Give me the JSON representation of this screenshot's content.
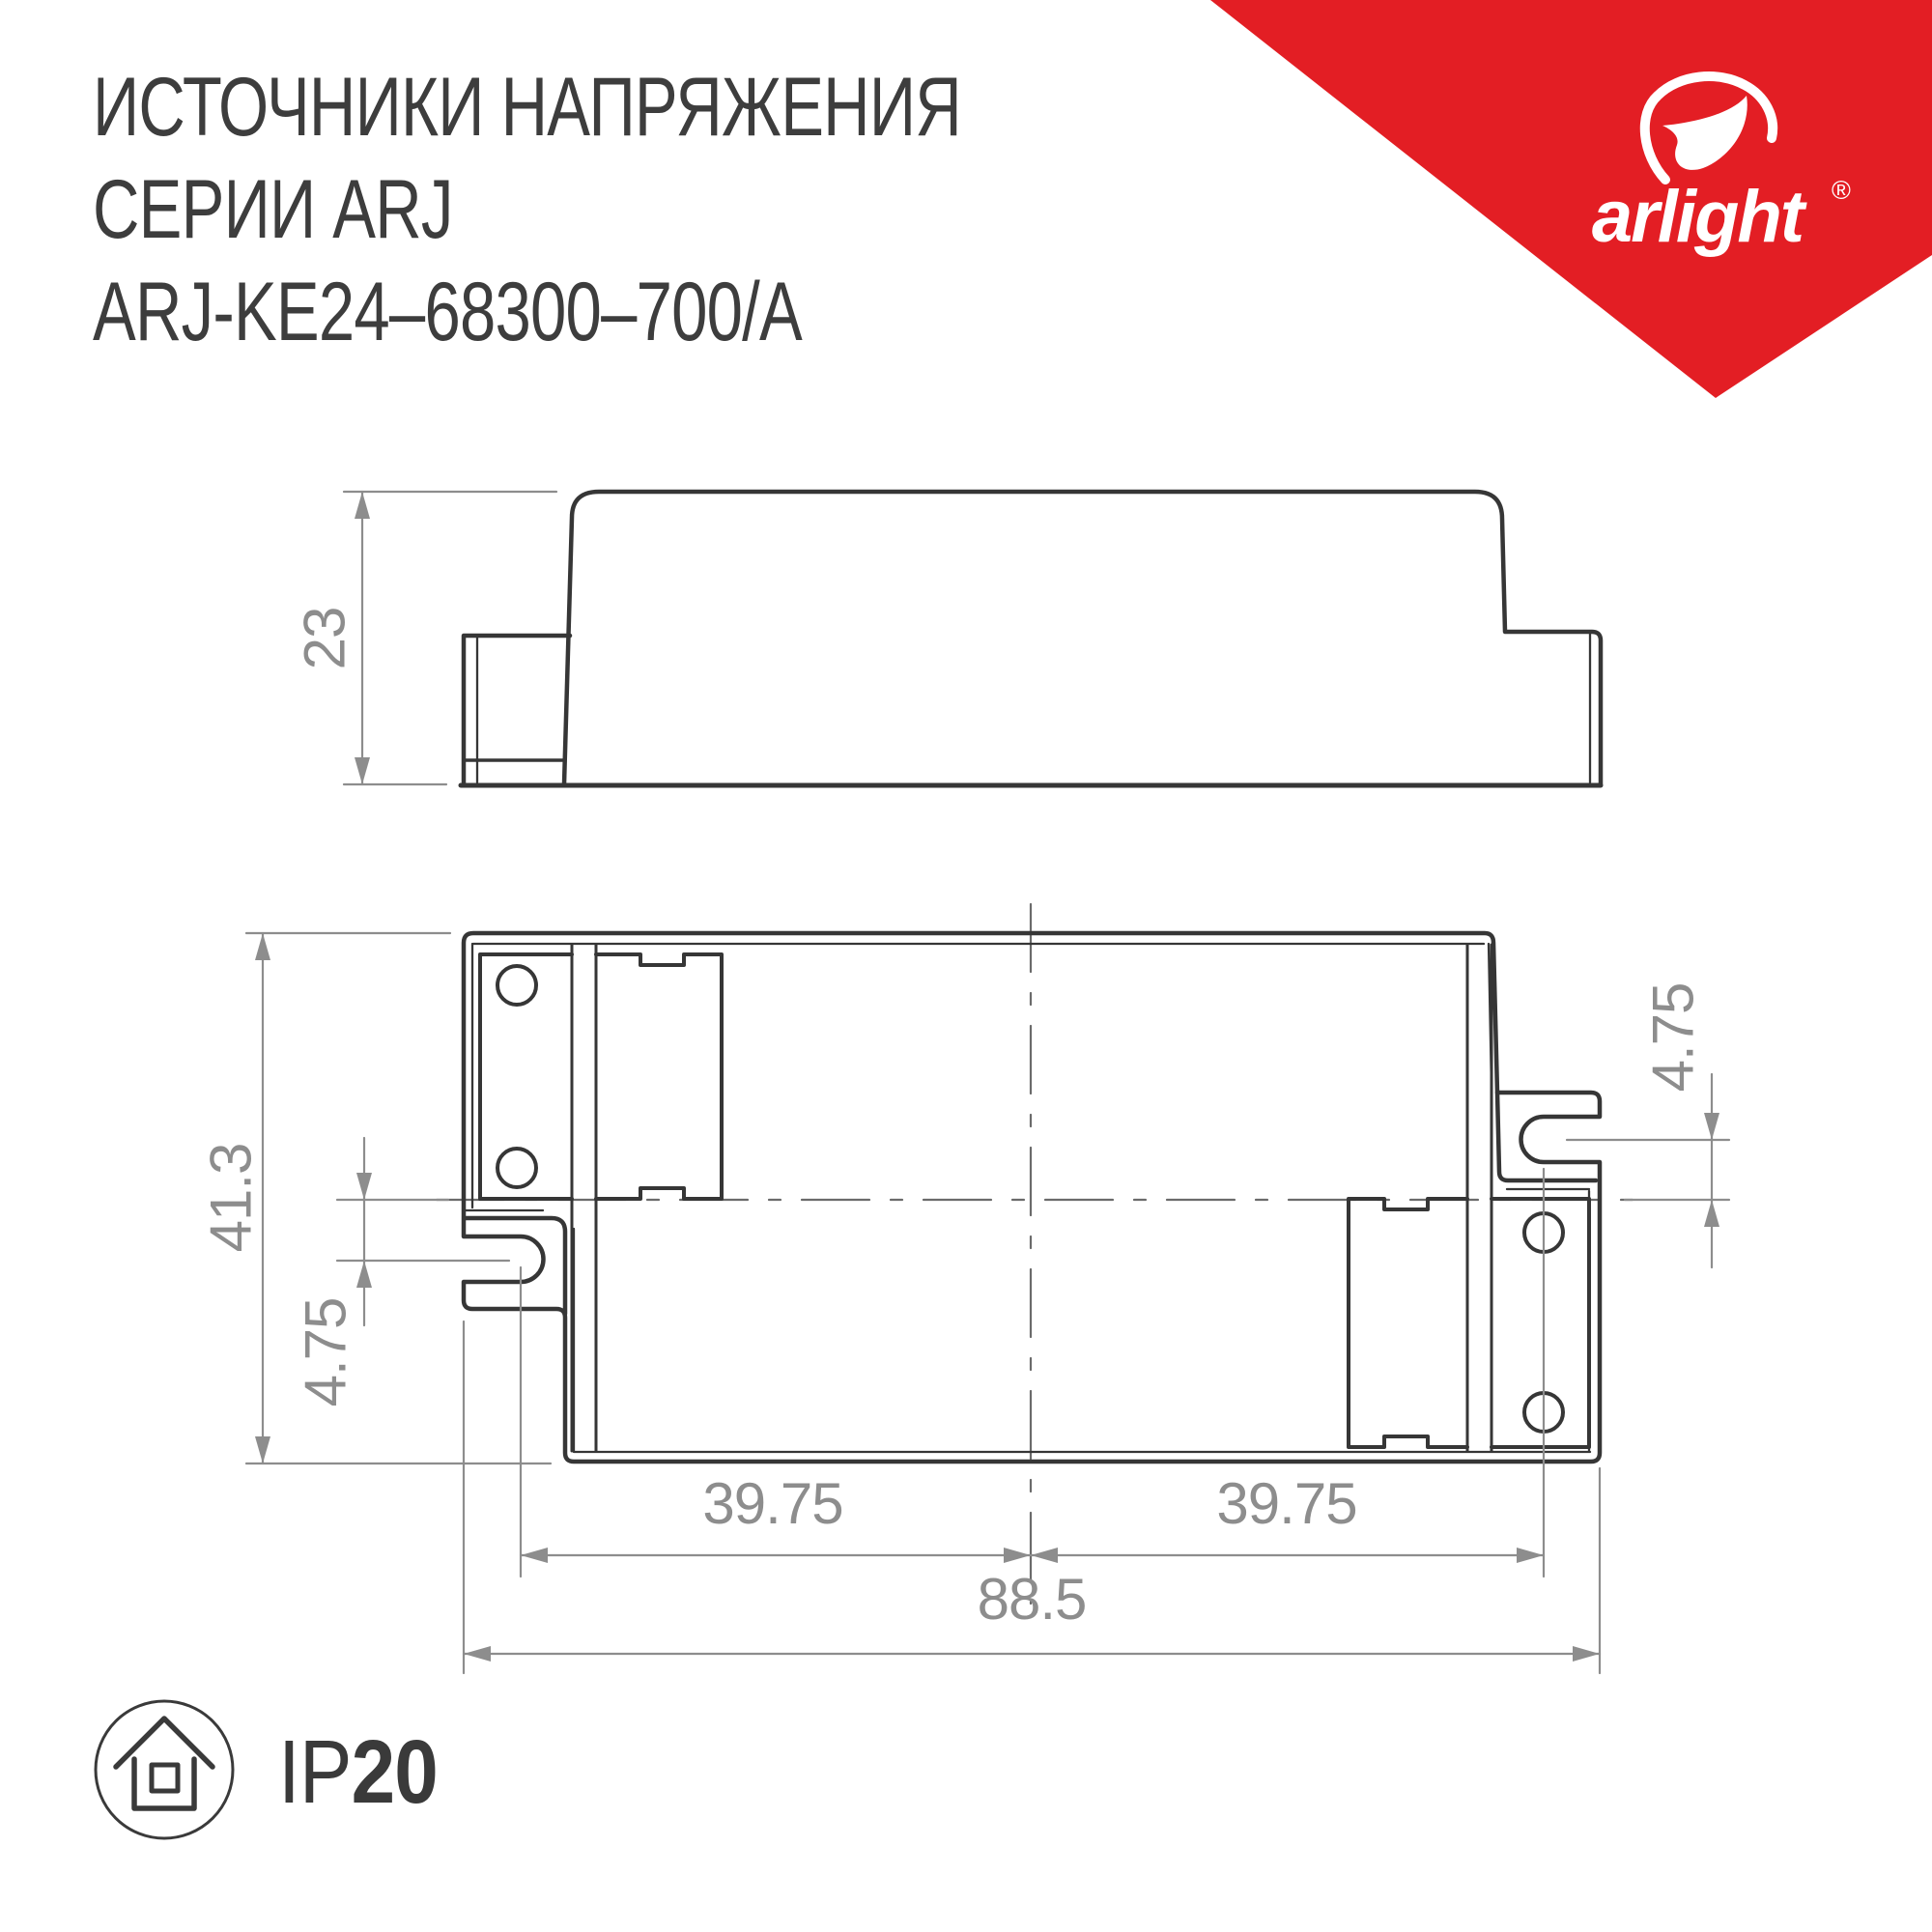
{
  "title": {
    "line1": "ИСТОЧНИКИ НАПРЯЖЕНИЯ",
    "line2": "СЕРИИ ARJ",
    "line3": "ARJ-KE24–68300–700/A"
  },
  "brand": {
    "wordmark": "arlight",
    "registered_mark": "®",
    "triangle_color": "#e31e24"
  },
  "drawing": {
    "views": [
      "side-view",
      "bottom-view"
    ],
    "dimensions": {
      "side_height": "23",
      "body_depth": "41.3",
      "slot_offset_left": "4.75",
      "slot_offset_right": "4.75",
      "mount_pitch_left": "39.75",
      "mount_pitch_right": "39.75",
      "body_width": "88.5"
    }
  },
  "footer": {
    "ip_prefix": "IP",
    "ip_value": "20"
  },
  "palette": {
    "line_dark": "#363636",
    "dim_gray": "#8d8d8d",
    "centerline_gray": "#6b6b6b",
    "text_dark": "#3d3d3d",
    "brand_red": "#e31e24"
  }
}
